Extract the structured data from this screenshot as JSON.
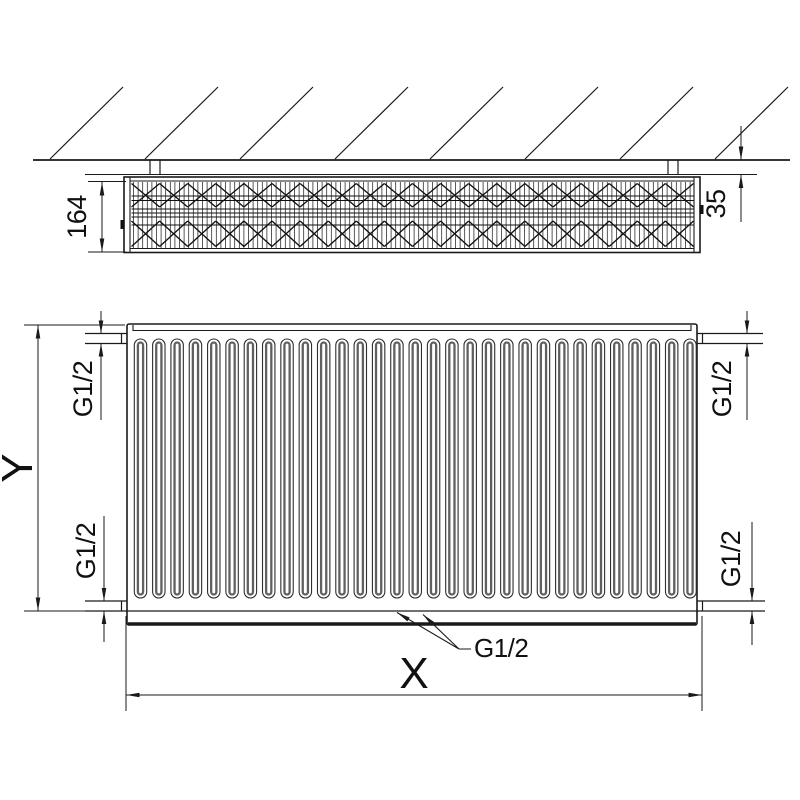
{
  "labels": {
    "depth": "164",
    "wall_gap": "35",
    "height": "Y",
    "width": "X",
    "conn_top_left": "G1/2",
    "conn_top_right": "G1/2",
    "conn_bottom_left": "G1/2",
    "conn_bottom_right": "G1/2",
    "conn_bottom_center": "G1/2"
  },
  "geometry": {
    "hatch_count": 8,
    "hatch_x_start": 50,
    "hatch_spacing": 95,
    "groove_count": 31,
    "groove_x_start": 140.5,
    "groove_spacing": 18.317,
    "fin_vertical_count": 122,
    "lattice_cell_count": 20,
    "panel_line_ys": [
      196,
      200.5,
      209,
      213,
      217,
      225
    ]
  },
  "colors": {
    "line": "#1a1a1a",
    "groove_outer": "#2e2e2e",
    "groove_inner": "#606060",
    "background": "#ffffff"
  }
}
